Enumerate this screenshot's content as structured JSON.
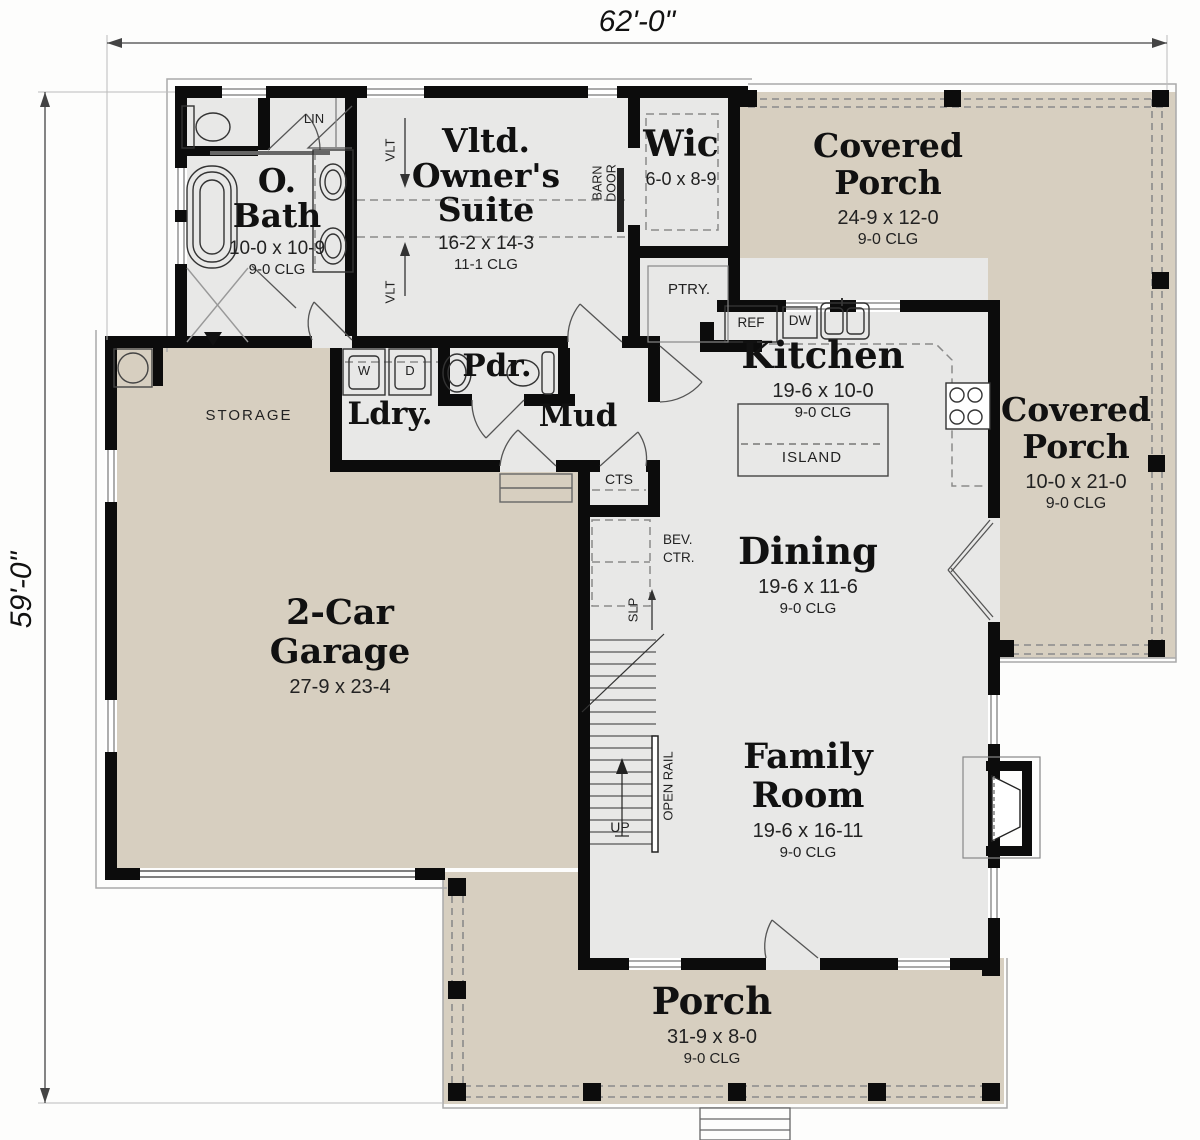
{
  "dimensions": {
    "width_label": "62'-0\"",
    "height_label": "59'-0\""
  },
  "colors": {
    "porch_fill": "#d7cfc0",
    "interior_fill": "#e8e8e7",
    "wall": "#0c0c0c",
    "background": "#fdfdfc"
  },
  "rooms": {
    "bath": {
      "name": "O.\nBath",
      "dim": "10-0 x 10-9",
      "clg": "9-0 CLG"
    },
    "owners_suite": {
      "name": "Vltd.\nOwner's\nSuite",
      "dim": "16-2 x 14-3",
      "clg": "11-1 CLG"
    },
    "wic": {
      "name": "Wic",
      "dim": "6-0 x 8-9"
    },
    "covered_porch_top": {
      "name": "Covered\nPorch",
      "dim": "24-9 x 12-0",
      "clg": "9-0 CLG"
    },
    "kitchen": {
      "name": "Kitchen",
      "dim": "19-6 x 10-0",
      "clg": "9-0 CLG",
      "island": "ISLAND"
    },
    "covered_porch_right": {
      "name": "Covered\nPorch",
      "dim": "10-0 x 21-0",
      "clg": "9-0 CLG"
    },
    "laundry": {
      "name": "Ldry.",
      "washer": "W",
      "dryer": "D"
    },
    "powder": {
      "name": "Pdr."
    },
    "mud": {
      "name": "Mud"
    },
    "garage": {
      "name": "2-Car\nGarage",
      "dim": "27-9 x 23-4",
      "storage": "STORAGE"
    },
    "dining": {
      "name": "Dining",
      "dim": "19-6 x 11-6",
      "clg": "9-0 CLG"
    },
    "family": {
      "name": "Family\nRoom",
      "dim": "19-6 x 16-11",
      "clg": "9-0 CLG"
    },
    "porch_bottom": {
      "name": "Porch",
      "dim": "31-9 x 8-0",
      "clg": "9-0 CLG"
    }
  },
  "annotations": {
    "lin": "LIN",
    "vlt": "VLT",
    "barn_door": "BARN\nDOOR",
    "ptry": "PTRY.",
    "ref": "REF",
    "dw": "DW",
    "cts": "CTS",
    "bev_ctr": "BEV.\nCTR.",
    "slp": "SLP",
    "up": "UP",
    "open_rail": "OPEN RAIL"
  }
}
